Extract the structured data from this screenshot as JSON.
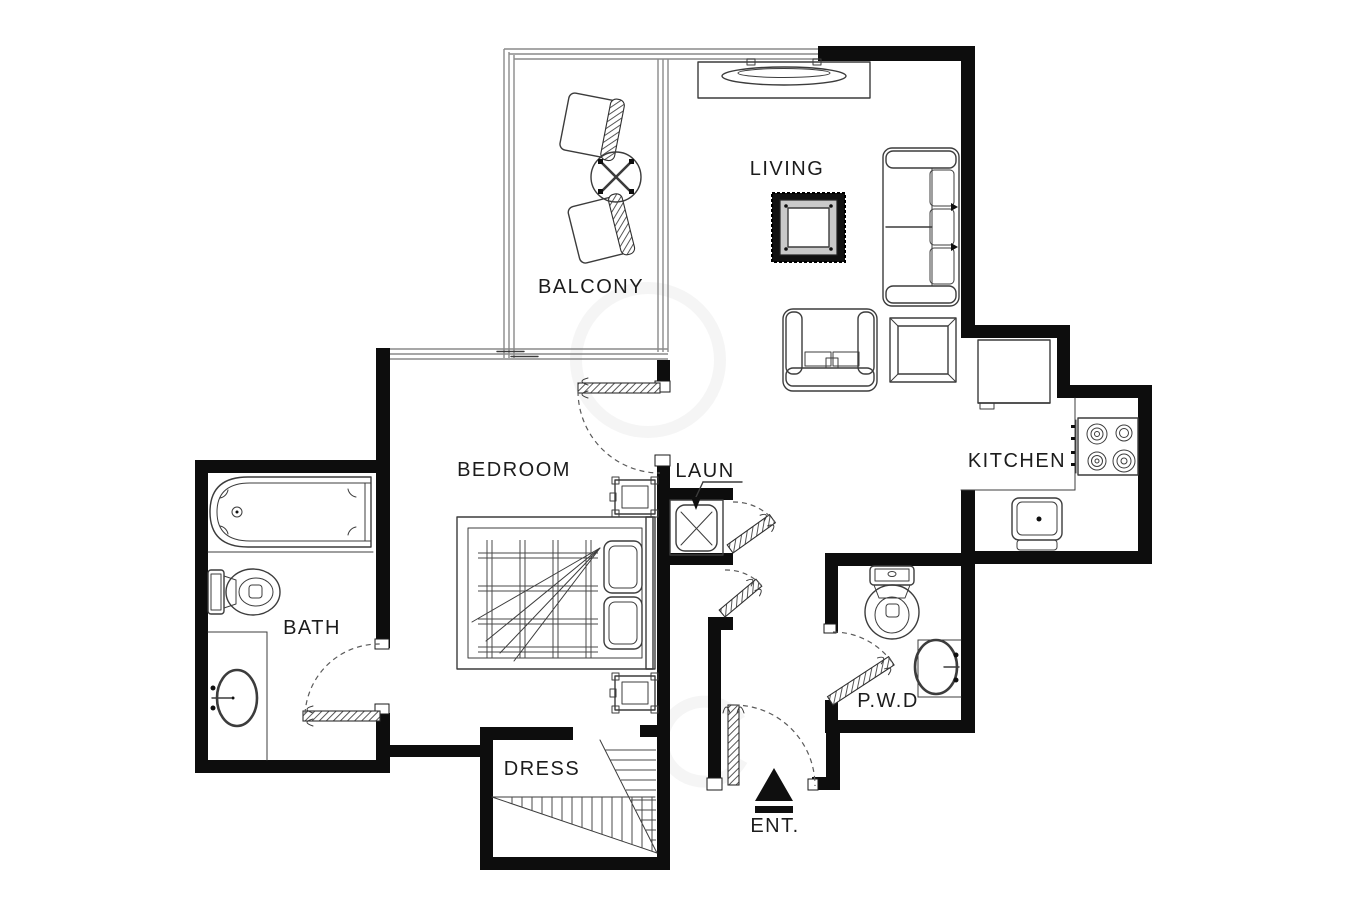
{
  "plan": {
    "name": "apartment-floor-plan",
    "labels": {
      "balcony": "BALCONY",
      "living": "LIVING",
      "kitchen": "KITCHEN",
      "bedroom": "BEDROOM",
      "bath": "BATH",
      "laundry": "LAUN",
      "dress": "DRESS",
      "powder": "P.W.D",
      "entrance": "ENT."
    },
    "colors": {
      "bg": "#ffffff",
      "wall": "#0d0d0d",
      "furniture_line": "#3c3c3c",
      "glass_line": "#8a8a8a",
      "arc": "#5a5a5a",
      "label": "#1c1c1c",
      "watermark": "#ececec"
    },
    "fixtures": [
      "balcony-chair",
      "balcony-round-table",
      "balcony-chair",
      "tv-console",
      "curved-tv",
      "framed-decor-table",
      "sofa",
      "end-table",
      "armchair",
      "fridge",
      "stove-4-burners",
      "kitchen-sink",
      "washing-machine",
      "bed",
      "pillow",
      "nightstand",
      "nightstand",
      "bathtub",
      "toilet",
      "vanity-sink",
      "toilet",
      "vanity-sink",
      "wardrobe-hatch",
      "entrance-arrow"
    ]
  }
}
